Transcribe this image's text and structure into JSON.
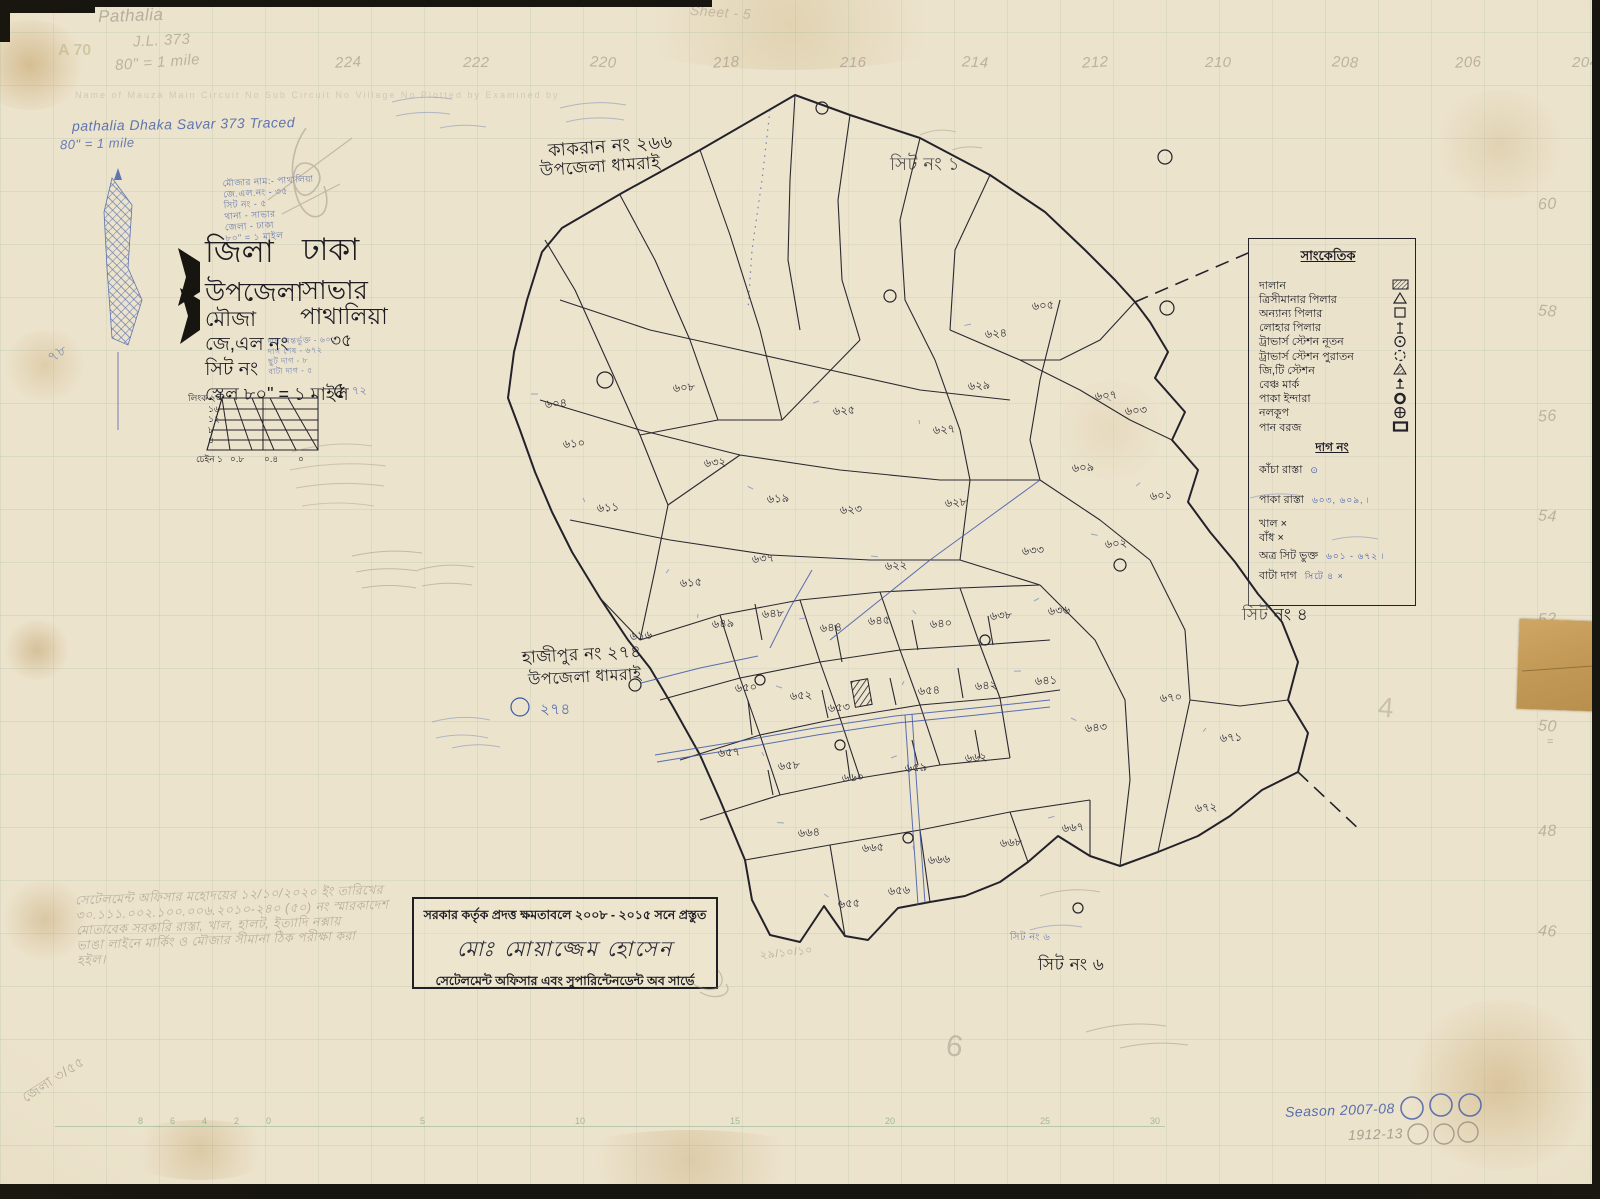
{
  "corner_notes": {
    "pencil_mauza": "Pathalia",
    "pencil_jl": "J.L. 373",
    "pencil_scale": "80\" = 1 mile",
    "a70": "A 70",
    "pencil_sheet": "Sheet - 5",
    "form_header": "Name of Mauza      Main Circuit No      Sub Circuit No      Village No      Plotted by      Examined by",
    "ink_row": "pathalia    Dhaka    Savar        373        Traced",
    "ink_scale": "80\" = 1 mile",
    "left_blue_78": "৭৮",
    "corner_scrawl": "জেলা ৩/৫৫"
  },
  "margin_numbers": {
    "top": [
      {
        "label": "224",
        "x": 335
      },
      {
        "label": "222",
        "x": 463
      },
      {
        "label": "220",
        "x": 590
      },
      {
        "label": "218",
        "x": 713
      },
      {
        "label": "216",
        "x": 840
      },
      {
        "label": "214",
        "x": 962
      },
      {
        "label": "212",
        "x": 1082
      },
      {
        "label": "210",
        "x": 1205
      },
      {
        "label": "208",
        "x": 1332
      },
      {
        "label": "206",
        "x": 1455
      },
      {
        "label": "204",
        "x": 1572
      }
    ],
    "right": [
      {
        "label": "60",
        "y": 196
      },
      {
        "label": "58",
        "y": 303
      },
      {
        "label": "56",
        "y": 408
      },
      {
        "label": "54",
        "y": 508
      },
      {
        "label": "52",
        "y": 611
      },
      {
        "label": "50",
        "y": 718
      },
      {
        "label": "48",
        "y": 823
      },
      {
        "label": "46",
        "y": 923
      }
    ],
    "right_extra": "=",
    "bottom_ruler": [
      {
        "label": "8",
        "x": 83
      },
      {
        "label": "6",
        "x": 115
      },
      {
        "label": "4",
        "x": 147
      },
      {
        "label": "2",
        "x": 179
      },
      {
        "label": "0",
        "x": 211
      },
      {
        "label": "5",
        "x": 365
      },
      {
        "label": "10",
        "x": 520
      },
      {
        "label": "15",
        "x": 675
      },
      {
        "label": "20",
        "x": 830
      },
      {
        "label": "25",
        "x": 985
      },
      {
        "label": "30",
        "x": 1095
      }
    ]
  },
  "title_block": {
    "rows": [
      {
        "label": "জিলা",
        "value": "ঢাকা"
      },
      {
        "label": "উপজেলা",
        "value": "সাভার"
      },
      {
        "label": "মৌজা",
        "value": "পাথালিয়া"
      },
      {
        "label": "জে,এল নং",
        "value": "৩৫"
      },
      {
        "label": "সিট নং",
        "value": "৫"
      }
    ],
    "scale_line": "স্কেল ৮০\" = ১ মাইল"
  },
  "blue_notes": {
    "top_lines": [
      "মৌজার নাম:- পাথালিয়া",
      "জে.এল.নং - ৩৫",
      "সিট নং - ৫",
      "থানা - সাভার",
      "জেলা - ঢাকা",
      "৮০\" = ১ মাইল"
    ],
    "beside_sit": [
      "দাগ অন্তর্ভুক্ত - ৬০১",
      "দাগ শেষ - ৬৭২",
      "ছুট দাগ - ৮",
      "বাটা দাগ - ৫"
    ],
    "seventy_two": "৭২"
  },
  "scale_diagram": {
    "left_labels": [
      "লিংক ২০",
      "১৬",
      "১২",
      "৮",
      "৪"
    ],
    "bottom_labels": [
      "চেইন ১",
      "০.৮",
      "০.৪",
      "০"
    ]
  },
  "map_labels": {
    "kakran_line1": "কাকরান নং ২৬৬",
    "kakran_line2": "উপজেলা ধামরাই",
    "hajipur_line1": "হাজীপুর নং ২৭৪",
    "hajipur_line2": "উপজেলা ধামরাই",
    "sheet1": "সিট নং ১",
    "sheet4": "সিট নং ৪",
    "sheet6": "সিট নং ৬",
    "sheet6_blue": "সিট নং ৬",
    "blue_274": "২৭৪",
    "big6": "6",
    "big4": "4"
  },
  "legend": {
    "title": "সাংকেতিক",
    "items": [
      {
        "label": "দালান",
        "symbol": "hatched-rect"
      },
      {
        "label": "ত্রিসীমানার পিলার",
        "symbol": "triangle"
      },
      {
        "label": "অন্যান্য পিলার",
        "symbol": "square"
      },
      {
        "label": "লোহার পিলার",
        "symbol": "iron-pillar"
      },
      {
        "label": "ট্রাভার্স স্টেশন নূতন",
        "symbol": "circle-dot"
      },
      {
        "label": "ট্রাভার্স স্টেশন পুরাতন",
        "symbol": "circle-dashed"
      },
      {
        "label": "জি,টি স্টেশন",
        "symbol": "triangle-filled"
      },
      {
        "label": "বেঞ্চ মার্ক",
        "symbol": "benchmark"
      },
      {
        "label": "পাকা ইন্দারা",
        "symbol": "circle-bold"
      },
      {
        "label": "নলকূপ",
        "symbol": "circle-cross"
      },
      {
        "label": "পান বরজ",
        "symbol": "rect-bold"
      }
    ],
    "dag_heading": "দাগ নং",
    "dag_items": [
      {
        "label": "কাঁচা রাস্তা",
        "mark": "",
        "note": "⊙"
      },
      {
        "label": "পাকা রাস্তা",
        "mark": "",
        "note": "৬০৩, ৬০৯, ৷"
      },
      {
        "label": "খাল",
        "mark": "×",
        "note": ""
      },
      {
        "label": "বাঁধ",
        "mark": "×",
        "note": ""
      },
      {
        "label": "অত্র সিট ভুক্ত",
        "mark": "",
        "note": "৬০১ - ৬৭২ ৷"
      },
      {
        "label": "বাটা দাগ",
        "mark": "",
        "note": "সিটে ৪ ×"
      }
    ]
  },
  "stamp": {
    "line1": "সরকার কর্তৃক প্রদত্ত ক্ষমতাবলে ২০০৮ - ২০১৫ সনে প্রস্তুত",
    "signature": "মোঃ মোয়াজ্জেম হোসেন",
    "line3": "সেটেলমেন্ট অফিসার এবং সুপারিন্টেনডেন্ট অব সার্ভে"
  },
  "pencil_note": {
    "lines": [
      "সেটেলমেন্ট অফিসার মহোদয়ের ১২/১০/২০২০ ইং তারিখের",
      "৩০.১১১.০০২.১০০.০০৬.২০১০-২৪০ (৫০) নং স্মারকাদেশ",
      "মোতাবেক সরকারি রাস্তা, খাল, হালট, ইত্যাদি নক্সায়",
      "ভাঙা লাইনে মার্কিং ও মৌজার সীমানা ঠিক পরীক্ষা করা",
      "হইল।"
    ],
    "date": "২৯/১০/১০"
  },
  "footer": {
    "season_line": "Season 2007-08",
    "year_line": "1912-13"
  },
  "colors": {
    "ink": "#23222a",
    "blue": "#3d59a8",
    "pencil": "#8b8276",
    "paper": "#ece3cc"
  },
  "map": {
    "outer": "795,95 850,115 920,138 990,175 1045,212 1085,250 1115,280 1135,302 1150,322 1168,352 1155,378 1185,412 1172,440 1198,470 1188,502 1210,532 1235,562 1258,594 1282,622 1298,662 1288,700 1308,733 1298,772 1262,790 1230,816 1198,836 1158,852 1120,866 1090,856 1058,836 1028,862 1000,882 965,896 930,902 898,908 868,940 845,936 824,906 800,942 770,935 752,900 745,860 720,800 700,755 672,705 650,668 628,640 600,598 572,552 552,512 535,472 520,430 508,398 514,352 527,300 542,252 562,228 622,193 700,150",
    "lines": [
      "545,240 575,290 612,372 640,435 668,505",
      "620,195 655,260 690,340 718,420",
      "700,150 730,235 760,330 782,420",
      "795,95 790,180 788,260 800,330",
      "850,115 838,200 842,280 860,340",
      "920,138 900,220 905,300 935,360",
      "990,175 955,250 950,330",
      "560,300 650,330 740,350 830,370 920,390 1010,400",
      "540,400 640,430 740,455 840,470 940,480 1040,480",
      "570,520 670,540 770,555 870,560 960,560",
      "960,560 1040,585",
      "1040,480 1100,520 1150,560",
      "950,330 1020,360 1080,390 1130,420 1172,440",
      "935,360 960,430 970,480 960,560",
      "1060,300 1040,380 1030,440 1040,480",
      "1135,302 1100,340 1060,360 1020,360",
      "640,435 718,420 782,420 860,340",
      "668,505 740,455",
      "668,505 655,570 640,640",
      "640,640 720,615 800,600 880,592 960,588 1040,585",
      "660,700 740,678 820,662 900,650 980,645 1050,640",
      "680,760 760,735 840,718 920,705 1000,698 1060,690",
      "700,820 780,795 860,778 940,765 1010,758",
      "720,615 740,678 760,735 780,795",
      "800,600 820,662 840,718 860,778",
      "880,592 900,650 920,705 940,765",
      "960,588 980,645 1000,698 1010,758",
      "745,860 830,845 920,830 1010,812 1090,800",
      "830,845 845,936",
      "920,830 930,902",
      "1010,812 1028,862",
      "1090,800 1090,856",
      "1150,560 1185,630 1190,700 1175,770 1158,852",
      "1190,700 1240,706 1288,700",
      "1040,585 1095,640 1125,700 1130,780 1120,866",
      "600,598 640,640",
      "755,604 762,640",
      "835,625 842,662",
      "912,620 918,650",
      "988,616 993,645",
      "748,700 752,735",
      "822,690 828,718",
      "890,678 896,705",
      "958,668 963,698",
      "768,770 773,795",
      "846,750 850,778",
      "912,740 918,765",
      "975,730 980,758"
    ],
    "blue_lines": [
      "655,755 735,742 815,728 895,716 975,708 1050,700",
      "657,762 737,749 817,735 897,723 977,715 1050,707",
      "830,640 880,600 930,560 985,520 1040,480",
      "905,715 910,790 915,860 918,905",
      "912,714 917,790 922,860 925,903",
      "770,648 790,608 812,570",
      "641,683 700,668 758,656"
    ],
    "blue_dotted": [
      "770,110 762,180 752,250 748,310"
    ],
    "dashed": [
      "1135,302 1255,250",
      "1298,772 1362,832"
    ],
    "circles": [
      {
        "x": 822,
        "y": 108,
        "r": 6
      },
      {
        "x": 605,
        "y": 380,
        "r": 8
      },
      {
        "x": 890,
        "y": 296,
        "r": 6
      },
      {
        "x": 1167,
        "y": 308,
        "r": 7
      },
      {
        "x": 1165,
        "y": 157,
        "r": 7
      },
      {
        "x": 635,
        "y": 685,
        "r": 6
      },
      {
        "x": 760,
        "y": 680,
        "r": 5
      },
      {
        "x": 840,
        "y": 745,
        "r": 5
      },
      {
        "x": 985,
        "y": 640,
        "r": 5
      },
      {
        "x": 908,
        "y": 838,
        "r": 5
      },
      {
        "x": 1078,
        "y": 908,
        "r": 5
      },
      {
        "x": 1120,
        "y": 565,
        "r": 6
      },
      {
        "x": 520,
        "y": 707,
        "r": 9,
        "blue": 1
      }
    ],
    "building": {
      "x": 853,
      "y": 680,
      "w": 17,
      "h": 26,
      "rot": -10
    },
    "plots": [
      {
        "n": "৬০৪",
        "x": 545,
        "y": 408
      },
      {
        "n": "৬১০",
        "x": 563,
        "y": 448
      },
      {
        "n": "৬১১",
        "x": 597,
        "y": 512
      },
      {
        "n": "৬০৮",
        "x": 673,
        "y": 392
      },
      {
        "n": "৬২৫",
        "x": 833,
        "y": 415
      },
      {
        "n": "৬৩২",
        "x": 704,
        "y": 467
      },
      {
        "n": "৬১৯",
        "x": 767,
        "y": 503
      },
      {
        "n": "৬২৩",
        "x": 840,
        "y": 514
      },
      {
        "n": "৬১৫",
        "x": 680,
        "y": 587
      },
      {
        "n": "৬৩৭",
        "x": 752,
        "y": 563
      },
      {
        "n": "৬২২",
        "x": 885,
        "y": 570
      },
      {
        "n": "৬২৮",
        "x": 945,
        "y": 507
      },
      {
        "n": "৬২৭",
        "x": 933,
        "y": 434
      },
      {
        "n": "৬২৯",
        "x": 968,
        "y": 390
      },
      {
        "n": "৬২৪",
        "x": 985,
        "y": 338
      },
      {
        "n": "৬০৫",
        "x": 1032,
        "y": 310
      },
      {
        "n": "৬০৩",
        "x": 1125,
        "y": 415
      },
      {
        "n": "৬০৯",
        "x": 1072,
        "y": 472
      },
      {
        "n": "৬০১",
        "x": 1150,
        "y": 500
      },
      {
        "n": "৬৩৩",
        "x": 1022,
        "y": 555
      },
      {
        "n": "৬০২",
        "x": 1105,
        "y": 548
      },
      {
        "n": "৬১৬",
        "x": 630,
        "y": 640
      },
      {
        "n": "৬৪৯",
        "x": 712,
        "y": 628
      },
      {
        "n": "৬৪৮",
        "x": 762,
        "y": 618
      },
      {
        "n": "৬৪৪",
        "x": 820,
        "y": 632
      },
      {
        "n": "৬৪৫",
        "x": 868,
        "y": 625
      },
      {
        "n": "৬৪০",
        "x": 930,
        "y": 628
      },
      {
        "n": "৬৩৮",
        "x": 990,
        "y": 620
      },
      {
        "n": "৬৩৬",
        "x": 1048,
        "y": 615
      },
      {
        "n": "৬৫০",
        "x": 735,
        "y": 692
      },
      {
        "n": "৬৫২",
        "x": 790,
        "y": 700
      },
      {
        "n": "৬৫৩",
        "x": 828,
        "y": 712
      },
      {
        "n": "৬৫৪",
        "x": 918,
        "y": 695
      },
      {
        "n": "৬৪২",
        "x": 975,
        "y": 690
      },
      {
        "n": "৬৪১",
        "x": 1035,
        "y": 685
      },
      {
        "n": "৬৫৭",
        "x": 718,
        "y": 757
      },
      {
        "n": "৬৫৮",
        "x": 778,
        "y": 770
      },
      {
        "n": "৬৬০",
        "x": 842,
        "y": 782
      },
      {
        "n": "৬৫৯",
        "x": 905,
        "y": 772
      },
      {
        "n": "৬৬২",
        "x": 965,
        "y": 762
      },
      {
        "n": "৬৪৩",
        "x": 1085,
        "y": 732
      },
      {
        "n": "৬৭০",
        "x": 1160,
        "y": 702
      },
      {
        "n": "৬৭১",
        "x": 1220,
        "y": 742
      },
      {
        "n": "৬০৭",
        "x": 1095,
        "y": 400
      },
      {
        "n": "৬৬৪",
        "x": 798,
        "y": 837
      },
      {
        "n": "৬৬৫",
        "x": 862,
        "y": 852
      },
      {
        "n": "৬৬৬",
        "x": 928,
        "y": 864
      },
      {
        "n": "৬৬৮",
        "x": 1000,
        "y": 847
      },
      {
        "n": "৬৬৭",
        "x": 1062,
        "y": 832
      },
      {
        "n": "৬৭২",
        "x": 1195,
        "y": 812
      },
      {
        "n": "৬৫৫",
        "x": 838,
        "y": 908
      },
      {
        "n": "৬৫৬",
        "x": 888,
        "y": 895
      }
    ]
  }
}
